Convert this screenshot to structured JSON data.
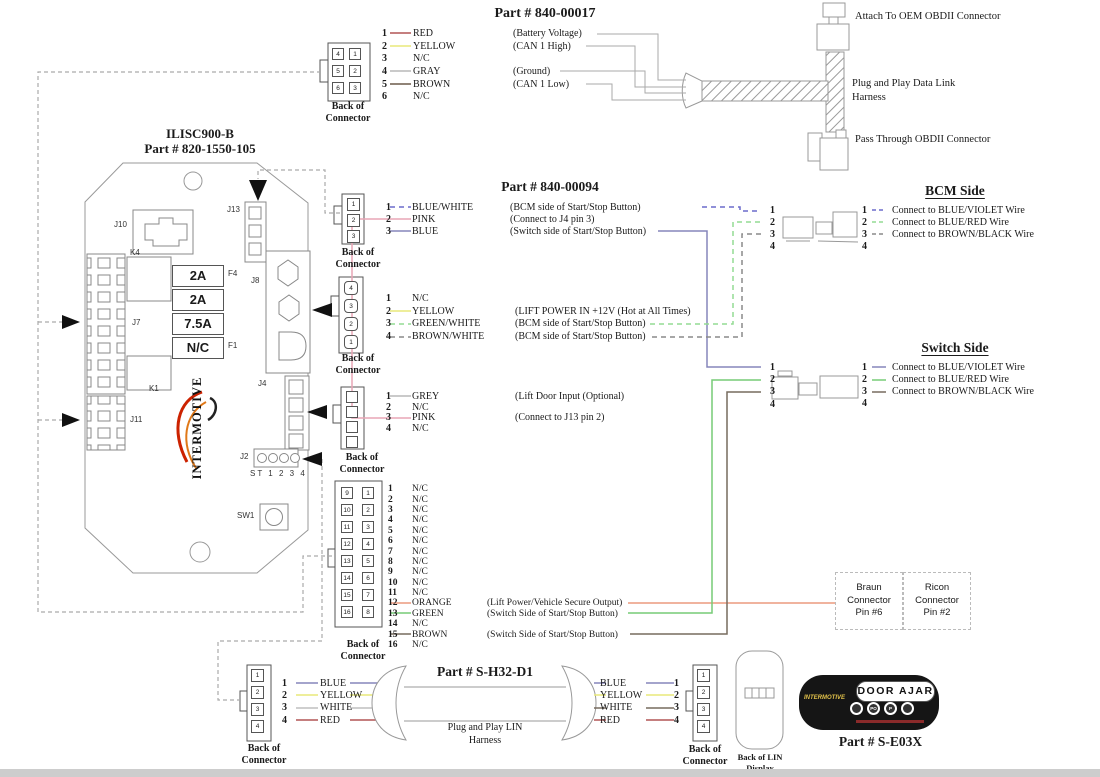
{
  "labels": {
    "back_of_connector": "Back of Connector",
    "ilisc_title1": "ILISC900-B",
    "ilisc_title2": "Part # 820-1550-105"
  },
  "wire_colors": {
    "red": "#b25555",
    "yellow": "#e9e97a",
    "gray": "#b9b9b9",
    "brown": "#6b5a4a",
    "pink": "#e9a6b6",
    "blue": "#8585bb",
    "blue_white": "#6b6bcc",
    "green_white": "#93dc93",
    "brown_white": "#8a8a8a",
    "green": "#77cc77",
    "orange": "#eb9a7e",
    "white": "#bfbfbf",
    "dark": "#776b5f",
    "routing": "#aaaaaa"
  },
  "p17": {
    "title": "Part # 840-00017",
    "cells": [
      "4",
      "1",
      "5",
      "2",
      "6",
      "3"
    ],
    "pins": [
      {
        "n": "1",
        "color": "RED",
        "func": "(Battery Voltage)"
      },
      {
        "n": "2",
        "color": "YELLOW",
        "func": "(CAN 1 High)"
      },
      {
        "n": "3",
        "color": "N/C",
        "func": ""
      },
      {
        "n": "4",
        "color": "GRAY",
        "func": "(Ground)"
      },
      {
        "n": "5",
        "color": "BROWN",
        "func": "(CAN 1 Low)"
      },
      {
        "n": "6",
        "color": "N/C",
        "func": ""
      }
    ]
  },
  "obd": {
    "attach": "Attach To OEM OBDII Connector",
    "harness": "Plug and Play Data Link Harness",
    "pass": "Pass Through OBDII Connector"
  },
  "module": {
    "refs": {
      "j10": "J10",
      "j13": "J13",
      "k4": "K4",
      "f4": "F4",
      "j7": "J7",
      "k1": "K1",
      "j11": "J11",
      "j8": "J8",
      "j4": "J4",
      "j2": "J2",
      "st": "ST 1 2 3 4",
      "sw1": "SW1",
      "f1": "F1"
    },
    "fuses": [
      "2A",
      "2A",
      "7.5A",
      "N/C"
    ],
    "logo": "INTERMOTIVE"
  },
  "p94": {
    "title": "Part # 840-00094",
    "cells": [
      "1",
      "2",
      "3"
    ],
    "pins": [
      {
        "n": "1",
        "color": "BLUE/WHITE",
        "func": "(BCM side of Start/Stop Button)"
      },
      {
        "n": "2",
        "color": "PINK",
        "func": "(Connect to J4 pin 3)"
      },
      {
        "n": "3",
        "color": "BLUE",
        "func": "(Switch side of Start/Stop Button)"
      }
    ]
  },
  "j8conn": {
    "cells": [
      "4",
      "3",
      "2",
      "1"
    ],
    "pins": [
      {
        "n": "1",
        "color": "N/C",
        "func": ""
      },
      {
        "n": "2",
        "color": "YELLOW",
        "func": "(LIFT POWER IN +12V (Hot at All Times)"
      },
      {
        "n": "3",
        "color": "GREEN/WHITE",
        "func": "(BCM side of Start/Stop Button)"
      },
      {
        "n": "4",
        "color": "BROWN/WHITE",
        "func": "(BCM side of Start/Stop Button)"
      }
    ]
  },
  "j4conn": {
    "cells": [
      "",
      "",
      "",
      ""
    ],
    "pins": [
      {
        "n": "1",
        "color": "GREY",
        "func": "(Lift Door Input (Optional)"
      },
      {
        "n": "2",
        "color": "N/C",
        "func": ""
      },
      {
        "n": "3",
        "color": "PINK",
        "func": "(Connect to J13 pin 2)"
      },
      {
        "n": "4",
        "color": "N/C",
        "func": ""
      }
    ]
  },
  "p16": {
    "cells": [
      "9",
      "1",
      "10",
      "2",
      "11",
      "3",
      "12",
      "4",
      "13",
      "5",
      "14",
      "6",
      "15",
      "7",
      "16",
      "8"
    ],
    "pins": [
      {
        "n": "1",
        "color": "N/C",
        "func": ""
      },
      {
        "n": "2",
        "color": "N/C",
        "func": ""
      },
      {
        "n": "3",
        "color": "N/C",
        "func": ""
      },
      {
        "n": "4",
        "color": "N/C",
        "func": ""
      },
      {
        "n": "5",
        "color": "N/C",
        "func": ""
      },
      {
        "n": "6",
        "color": "N/C",
        "func": ""
      },
      {
        "n": "7",
        "color": "N/C",
        "func": ""
      },
      {
        "n": "8",
        "color": "N/C",
        "func": ""
      },
      {
        "n": "9",
        "color": "N/C",
        "func": ""
      },
      {
        "n": "10",
        "color": "N/C",
        "func": ""
      },
      {
        "n": "11",
        "color": "N/C",
        "func": ""
      },
      {
        "n": "12",
        "color": "ORANGE",
        "func": "(Lift Power/Vehicle Secure Output)"
      },
      {
        "n": "13",
        "color": "GREEN",
        "func": "(Switch Side of Start/Stop Button)"
      },
      {
        "n": "14",
        "color": "N/C",
        "func": ""
      },
      {
        "n": "15",
        "color": "BROWN",
        "func": "(Switch Side of Start/Stop Button)"
      },
      {
        "n": "16",
        "color": "N/C",
        "func": ""
      }
    ]
  },
  "bcm": {
    "title": "BCM Side",
    "nums": [
      "1",
      "2",
      "3",
      "4"
    ],
    "pins": [
      {
        "n": "1",
        "label": "Connect to BLUE/VIOLET Wire"
      },
      {
        "n": "2",
        "label": "Connect to BLUE/RED Wire"
      },
      {
        "n": "3",
        "label": "Connect to BROWN/BLACK Wire"
      },
      {
        "n": "4",
        "label": ""
      }
    ]
  },
  "sw": {
    "title": "Switch Side",
    "nums": [
      "1",
      "2",
      "3",
      "4"
    ],
    "pins": [
      {
        "n": "1",
        "label": "Connect to BLUE/VIOLET Wire"
      },
      {
        "n": "2",
        "label": "Connect to BLUE/RED Wire"
      },
      {
        "n": "3",
        "label": "Connect to BROWN/BLACK Wire"
      },
      {
        "n": "4",
        "label": ""
      }
    ]
  },
  "boxes": {
    "braun": "Braun\nConnector\nPin #6",
    "ricon": "Ricon\nConnector\nPin #2"
  },
  "lin": {
    "title": "Part # S-H32-D1",
    "harness": "Plug and Play LIN Harness",
    "left_cells": [
      "1",
      "2",
      "3",
      "4"
    ],
    "right_cells": [
      "1",
      "2",
      "3",
      "4"
    ],
    "left_pins": [
      {
        "n": "1",
        "color": "BLUE"
      },
      {
        "n": "2",
        "color": "YELLOW"
      },
      {
        "n": "3",
        "color": "WHITE"
      },
      {
        "n": "4",
        "color": "RED"
      }
    ],
    "right_pins": [
      {
        "color": "BLUE",
        "n": "1"
      },
      {
        "color": "YELLOW",
        "n": "2"
      },
      {
        "color": "WHITE",
        "n": "3"
      },
      {
        "color": "RED",
        "n": "4"
      }
    ]
  },
  "lin_display": {
    "back_label": "Back of LIN Display"
  },
  "door": {
    "text": "DOOR  AJAR",
    "logo": "INTERMOTIVE",
    "buttons": [
      "",
      "PO",
      "P",
      ""
    ],
    "part": "Part # S-E03X"
  }
}
